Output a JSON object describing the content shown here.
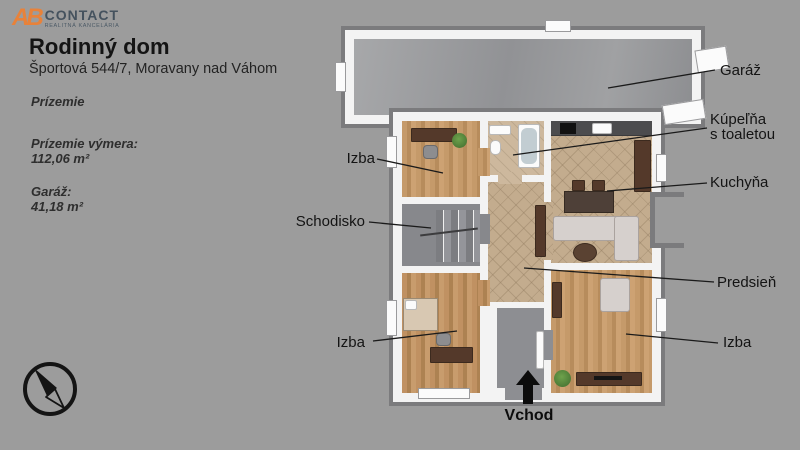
{
  "logo": {
    "ab": "AB",
    "name": "CONTACT",
    "tagline": "REALITNÁ KANCELÁRIA",
    "ab_color": "#e8823a",
    "text_color": "#45525e"
  },
  "header": {
    "title": "Rodinný dom",
    "address": "Športová 544/7, Moravany nad Váhom"
  },
  "details": {
    "floor": "Prízemie",
    "area_label": "Prízemie výmera:",
    "area_value": "112,06 m²",
    "garage_label": "Garáž:",
    "garage_value": "41,18 m²"
  },
  "plan_labels": {
    "garage": "Garáž",
    "bathroom_l1": "Kúpeľňa",
    "bathroom_l2": "s toaletou",
    "kitchen": "Kuchyňa",
    "hallway": "Predsieň",
    "room_right": "Izba",
    "room_top_left": "Izba",
    "stairs": "Schodisko",
    "room_bottom_left": "Izba",
    "entrance": "Vchod"
  },
  "icons": {
    "compass": "compass-icon",
    "entrance_arrow": "arrow-up-icon"
  },
  "colors": {
    "background": "#9c9c9c",
    "wall_white": "#f3f3f3",
    "wall_rim": "#7b7b7d",
    "wood_floor": "#bc9164",
    "tile_floor": "#c3ac8e",
    "concrete_floor": "#98999c",
    "label_text": "#141414"
  }
}
